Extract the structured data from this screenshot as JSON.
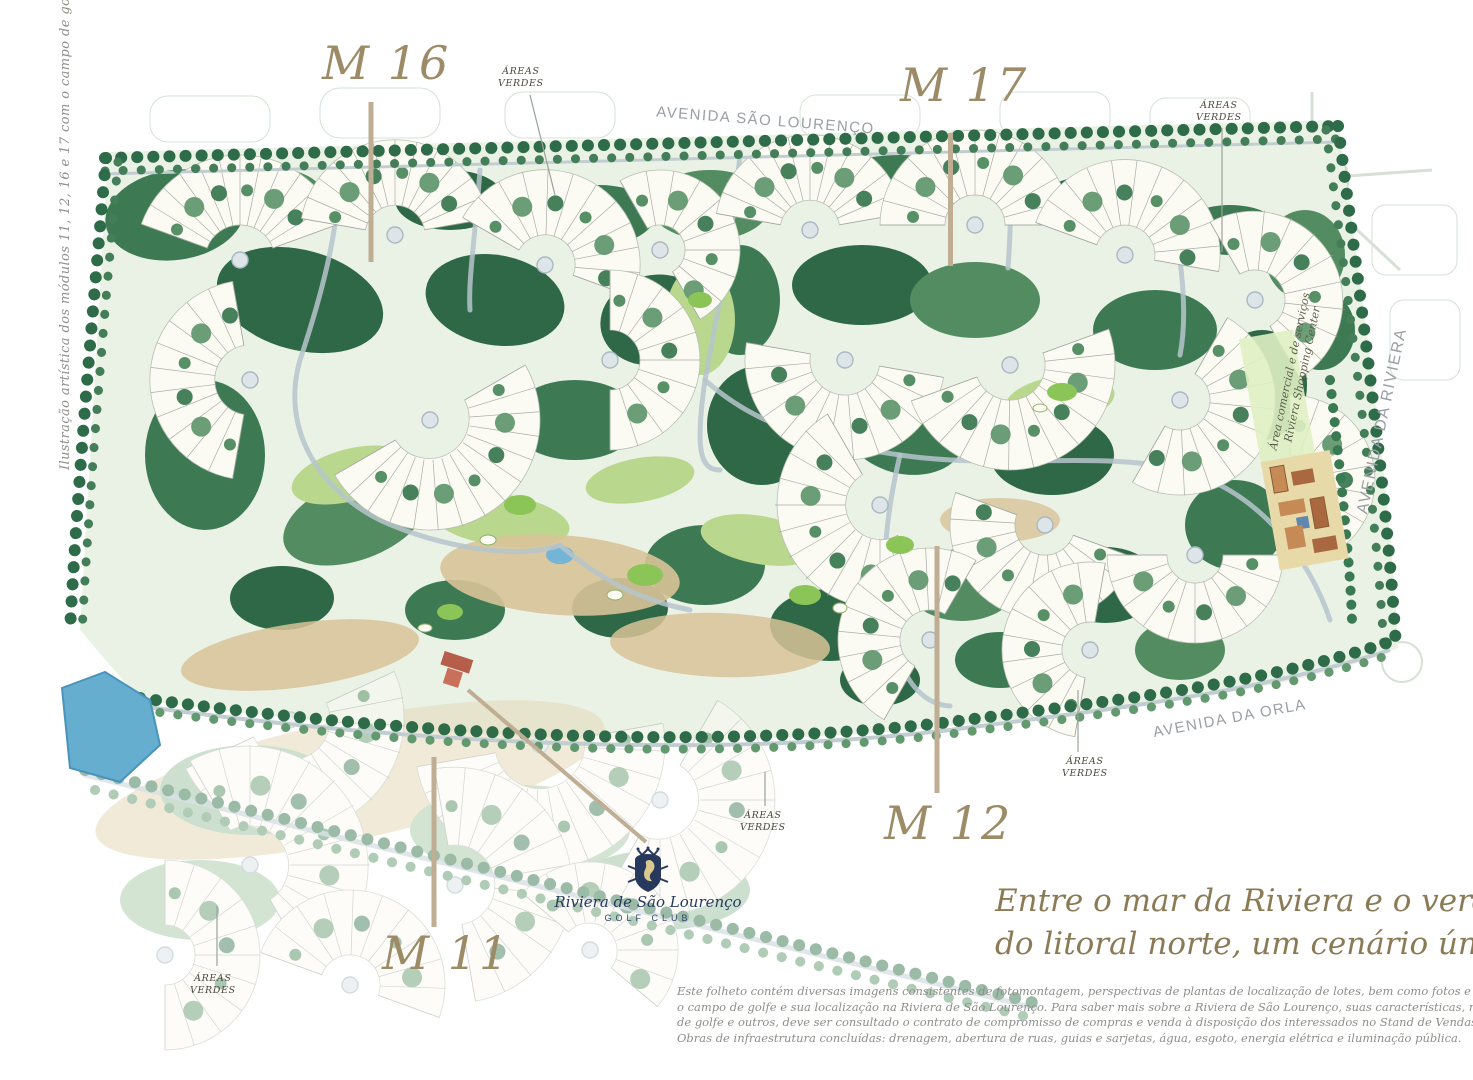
{
  "caption_left": "Ilustração artística dos módulos 11, 12, 16 e 17 com o campo de golfe",
  "modules": {
    "m16": "M 16",
    "m17": "M 17",
    "m12": "M 12",
    "m11": "M 11"
  },
  "streets": {
    "sao_lourenco": "AVENIDA SÃO LOURENÇO",
    "riviera": "AVENIDA DA RIVIERA",
    "orla": "AVENIDA DA ORLA"
  },
  "areas_verdes": {
    "line1": "ÁREAS",
    "line2": "VERDES"
  },
  "shopping": {
    "line1": "Área comercial e de serviços",
    "line2": "Riviera Shopping Center"
  },
  "logo": {
    "name": "Riviera de São Lourenço",
    "subtitle": "GOLF CLUB"
  },
  "tagline": {
    "line1": "Entre o mar da Riviera e o verde",
    "line2": "do litoral norte, um cenário único."
  },
  "disclaimer": {
    "lines": [
      "Este folheto contém diversas imagens consistentes de fotomontagem, perspectivas de plantas de localização de lotes, bem como fotos e desenhos ilustrativos para apresentar, inclusive,",
      "o campo de golfe e sua localização na Riviera de São Lourenço. Para saber mais sobre a Riviera de São Lourenço, suas características, normas de uso e ocupação do solo, utilização do campo",
      "de golfe e outros, deve ser consultado o contrato de compromisso de compras e venda à disposição dos interessados no Stand de Vendas do SIV - Sistema Integrado de Vendas, na Riviera.",
      "Obras de infraestrutura concluídas: drenagem, abertura de ruas, guias e sarjetas, água, esgoto, energia elétrica e iluminação pública."
    ]
  },
  "colors": {
    "module_label": "#9c8b66",
    "leader_bar": "#bfae93",
    "street_gray": "#999fa4",
    "navy": "#273a5e",
    "tree_dark": "#2e6847",
    "fairway": "#b9d88e",
    "sand": "#d8c398",
    "water": "#66aed0"
  }
}
